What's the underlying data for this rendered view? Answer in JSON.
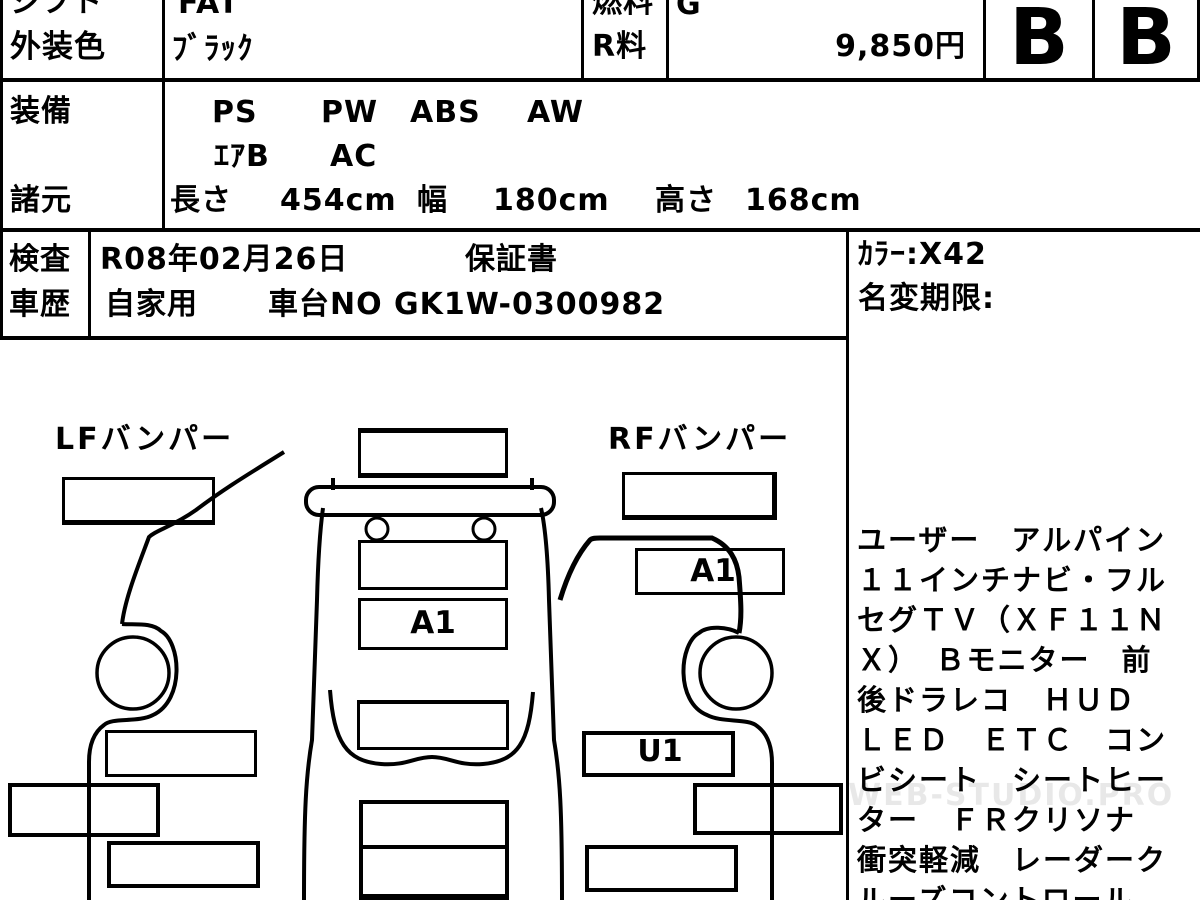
{
  "sheet": {
    "row_shift": {
      "label": "シフト",
      "value": "FAT"
    },
    "row_color": {
      "label": "外装色",
      "value": "ﾌﾞﾗｯｸ"
    },
    "row_fuel": {
      "label": "燃料",
      "value": "G"
    },
    "row_rfee": {
      "label": "R料",
      "value": "9,850円"
    },
    "grades": {
      "exterior": "B",
      "interior": "B"
    },
    "row_equip": {
      "label": "装備",
      "items": [
        "PS",
        "PW",
        "ABS",
        "AW"
      ],
      "items2": [
        "ｴｱB",
        "AC"
      ]
    },
    "row_specs": {
      "label": "諸元",
      "length_label": "長さ",
      "length": "454cm",
      "width_label": "幅",
      "width": "180cm",
      "height_label": "高さ",
      "height": "168cm"
    },
    "row_inspect": {
      "label": "検査",
      "date": "R08年02月26日",
      "warranty": "保証書"
    },
    "row_history": {
      "label": "車歴",
      "usage": "自家用",
      "chassis": "車台NO GK1W-0300982"
    },
    "side": {
      "color_code": "ｶﾗｰ:X42",
      "name_change_label": "名変期限:"
    }
  },
  "diagram": {
    "lf_label": "LFバンパー",
    "rf_label": "RFバンパー",
    "center_mark": "A1",
    "rf_mark": "A1",
    "rf_door_mark": "U1"
  },
  "notes": {
    "lines": [
      "ユーザー　アルパイン",
      "１１インチナビ・フル",
      "セグＴＶ（ＸＦ１１Ｎ",
      "Ｘ）　Ｂモニター　前",
      "後ドラレコ　ＨＵＤ",
      "ＬＥＤ　ＥＴＣ　コン",
      "ビシート　シートヒー",
      "ター　ＦＲクリソナ",
      "衝突軽減　レーダーク",
      "ルーズコントロール"
    ]
  },
  "watermark": "WEB-STUDIO.PRO"
}
